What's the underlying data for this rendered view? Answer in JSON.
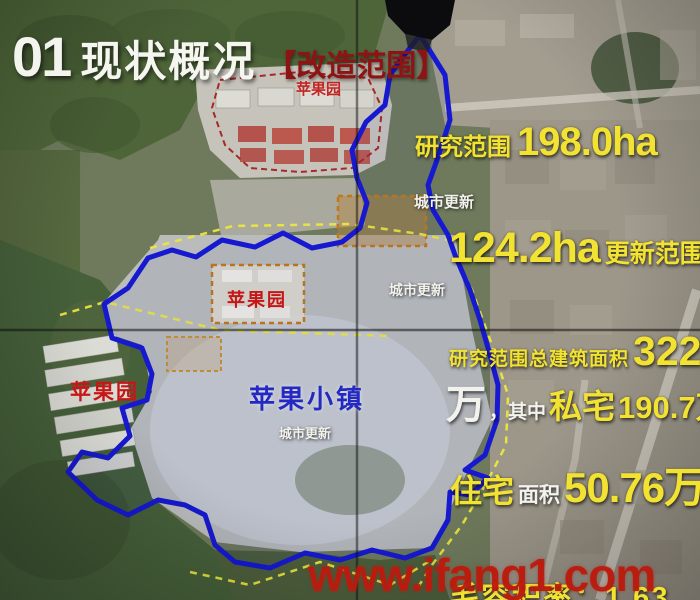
{
  "slide": {
    "title": {
      "number": "01",
      "text": "现状概况",
      "bracket": "【改造范围】"
    }
  },
  "map_labels": {
    "apple_garden_top": "苹果园",
    "apple_garden_mid": "苹果园",
    "apple_garden_left": "苹果园",
    "apple_town": "苹果小镇",
    "urban_renewal_1": "城市更新",
    "urban_renewal_2": "城市更新",
    "urban_renewal_3": "城市更新"
  },
  "stats": {
    "research_scope_label": "研究范围",
    "research_scope_value": "198.0ha",
    "renewal_value": "124.2ha",
    "renewal_label": "更新范围",
    "total_floor_label": "研究范围总建筑面积",
    "total_floor_value": "322",
    "total_floor_unit": "万",
    "qizhong": "，其中",
    "private_home_label": "私宅",
    "private_home_value": "190.7万",
    "residence_label": "住宅",
    "residence_area_label": "面积",
    "residence_value": "50.76万",
    "plot_ratio_partial": "毛容积率：1.63"
  },
  "watermark": {
    "text": "www.ifang1.com"
  },
  "colors": {
    "stat_yellow": "#f2e232",
    "stat_white": "#f2f2ee",
    "title_bracket_red": "#8e1414",
    "map_label_red": "#c81616",
    "town_blue": "#2329c2",
    "boundary_blue": "#1619cf",
    "boundary_yellow": "#ece63e",
    "boundary_red": "#a82828",
    "boundary_orange": "#c07818",
    "watermark_red": "#bb1a0e"
  }
}
